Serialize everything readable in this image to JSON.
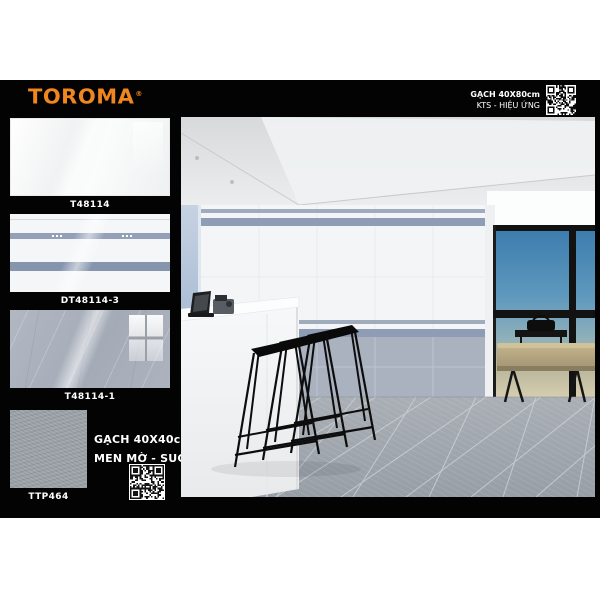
{
  "brand": {
    "name": "TOROMA",
    "reg": "®",
    "color": "#F0861E"
  },
  "header": {
    "size_line": "GẠCH 40X80cm",
    "effect_line": "KTS - HIỆU ỨNG",
    "qr_icon": "qr-code"
  },
  "swatches": [
    {
      "code": "T48114",
      "finish": "white-gloss"
    },
    {
      "code": "DT48114-3",
      "finish": "decor-stripes"
    },
    {
      "code": "T48114-1",
      "finish": "gray-marble"
    },
    {
      "code": "TTP464",
      "finish": "gray-texture"
    }
  ],
  "floor_info": {
    "size_line": "GẠCH 40X40cm",
    "finish_line": "MEN MỜ - SUGAR",
    "qr_icon": "qr-code"
  },
  "scene": {
    "alt": "Interior render: white tiled wall with blue-gray stripe decor, gray marble wainscot, gray textured floor tiles, white counter with devices, black wire bar stools, window with blue sky and beige bench"
  },
  "colors": {
    "poster_black": "#030303",
    "brand_orange": "#F0861E",
    "stripe_blue": "#8E9CB6",
    "stripe_blue_light": "#A0ABBE",
    "wainscot_gray": "#AAB2C0",
    "floor_gray": "#9BA2A9",
    "sky_blue": "#3C7CAE",
    "bench_tan": "#B7A982"
  },
  "qr_styles": {
    "header": {
      "dark": "#ffffff",
      "light": "#0a0a0a"
    },
    "floor": {
      "dark": "#141414",
      "light": "#ffffff"
    }
  }
}
